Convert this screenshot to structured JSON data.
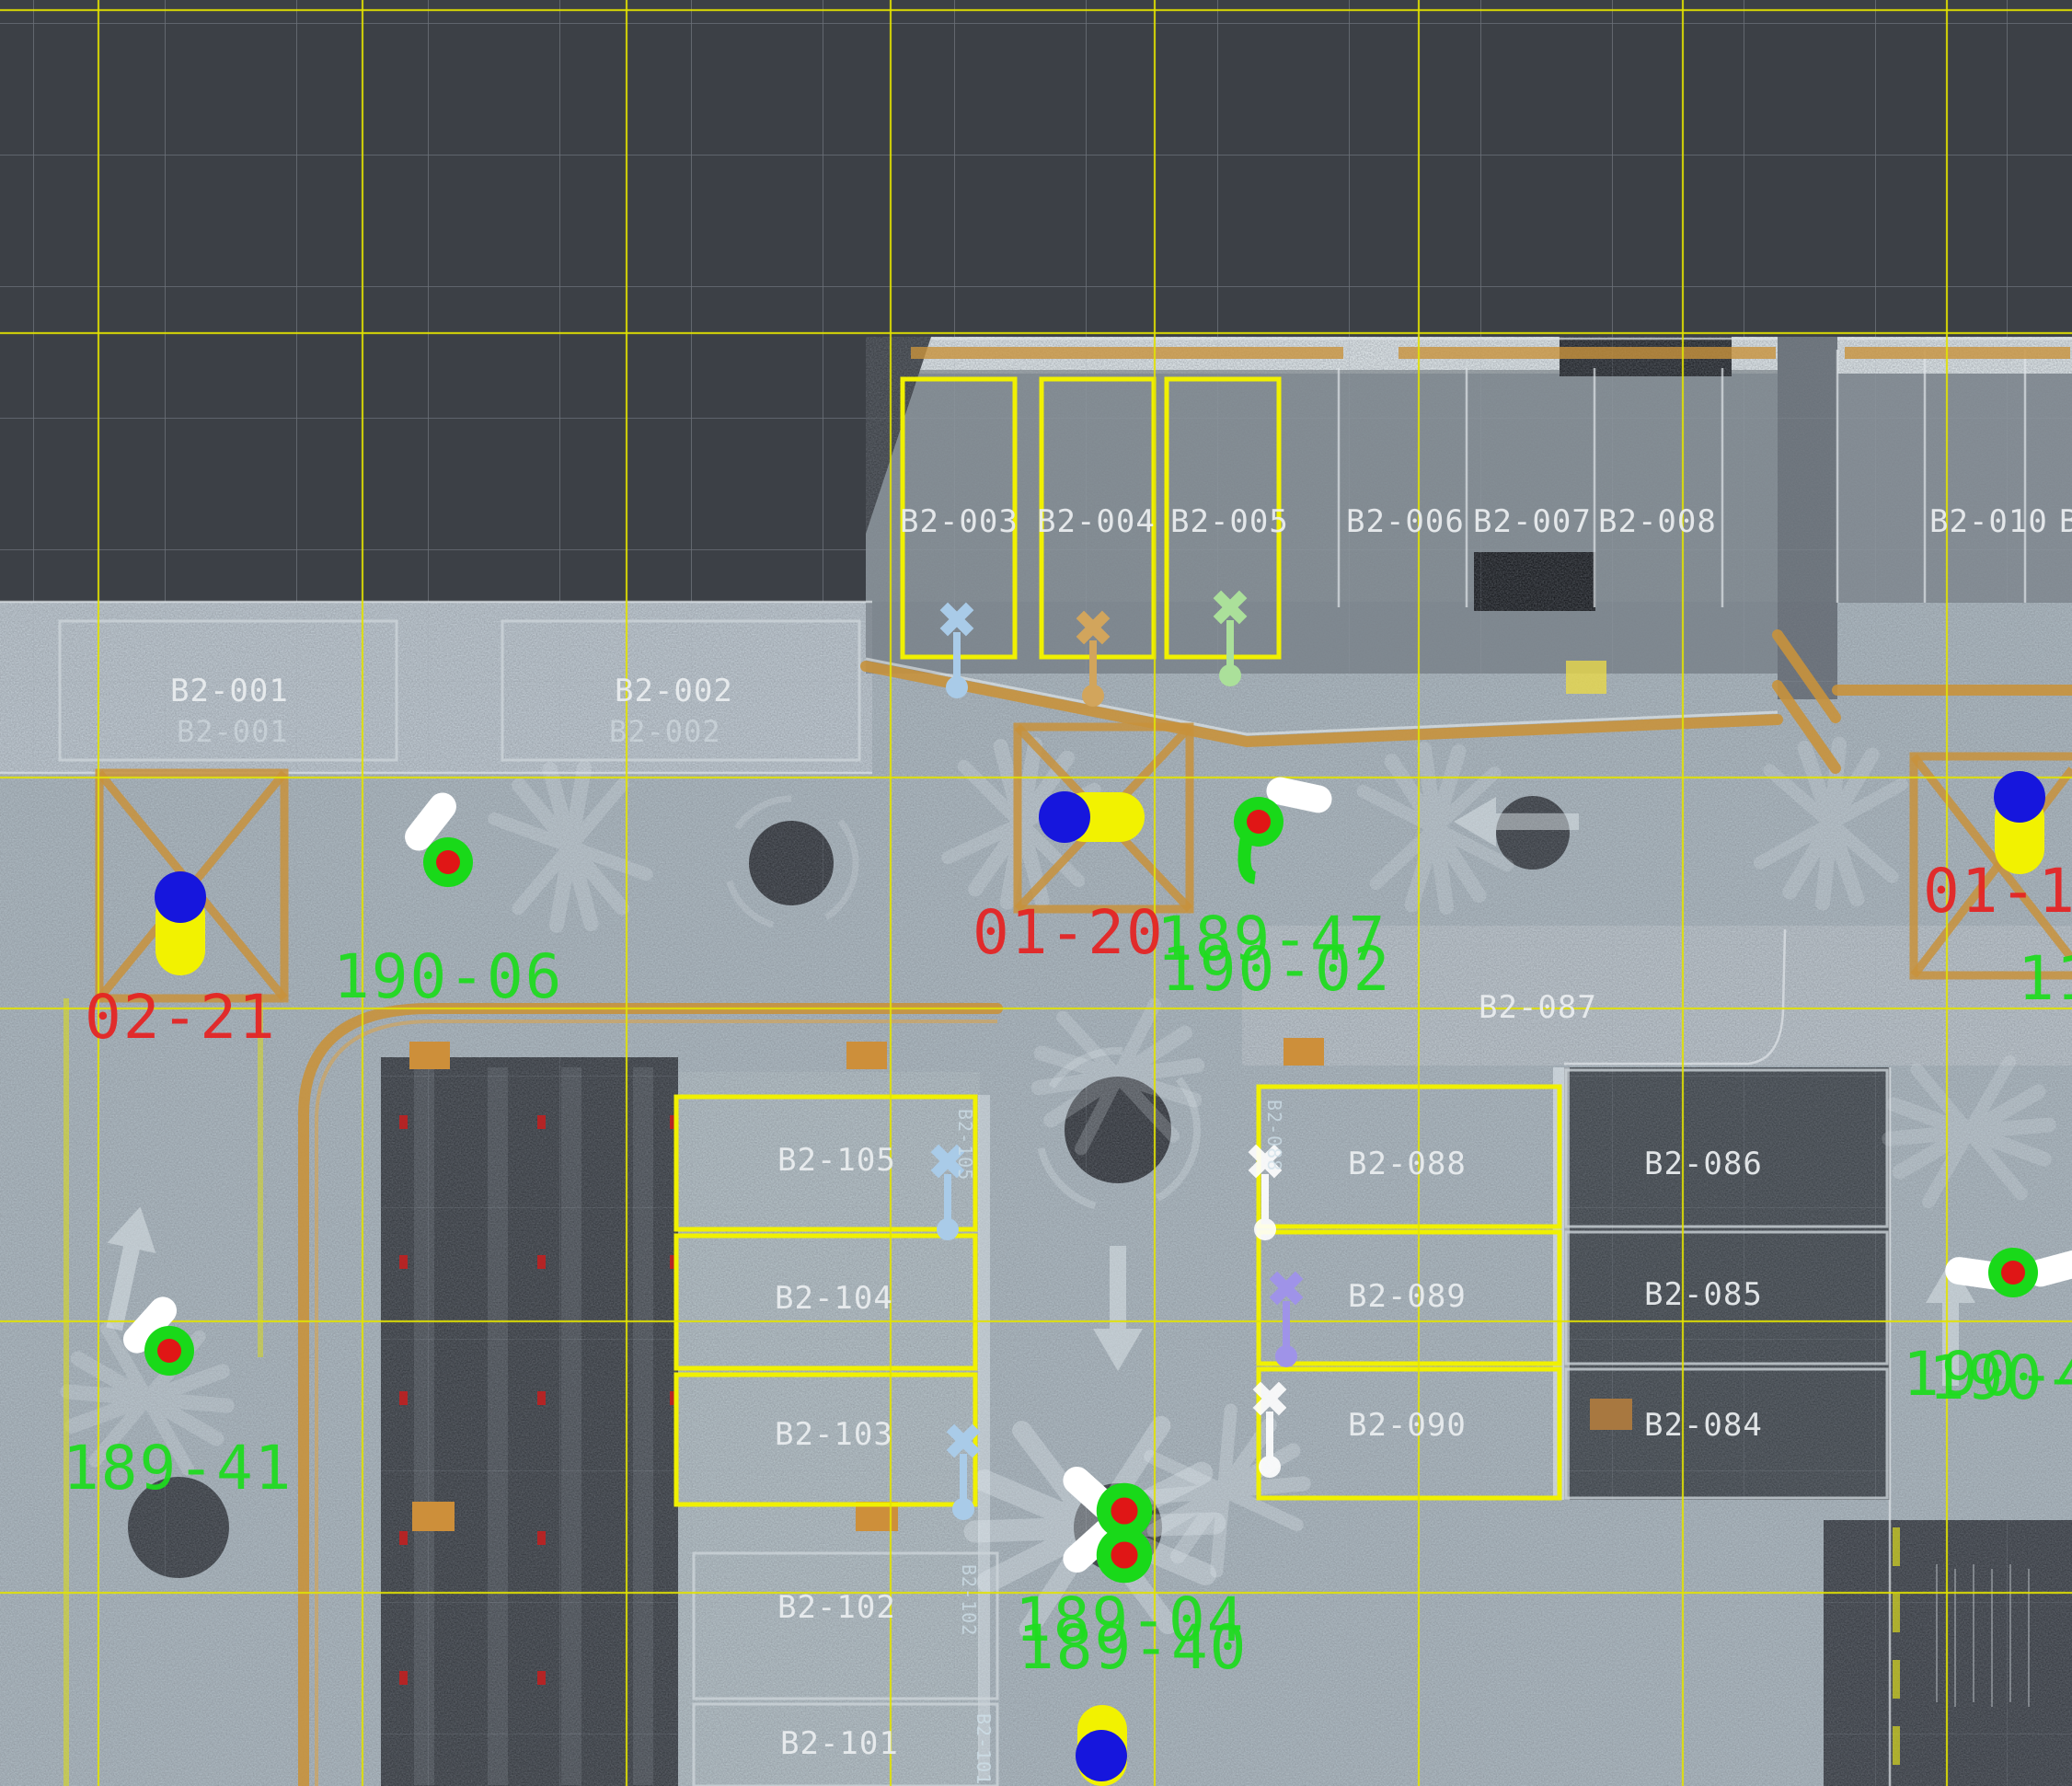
{
  "view": {
    "type": "point-cloud-plan",
    "level": "B2"
  },
  "colors": {
    "bg": "#3c4046",
    "pavement": "#adb9c1",
    "slab_light": "#c6cfd5",
    "dark_area": "#2c3036",
    "grid_gray": "#9aa2ab",
    "grid_yellow": "#e3e300",
    "stall_outline_yellow": "#f0f000",
    "outline_white": "#dfe4e8",
    "curb_orange": "#c8923c",
    "text_white": "#e9edef",
    "text_red": "#e62222",
    "text_green": "#1edc1e",
    "marker_blue": "#1616dd",
    "marker_yellow": "#f2f200",
    "marker_green": "#19d919",
    "marker_red": "#e01616",
    "pin_blue": "#a9cbe8",
    "pin_tan": "#d2a55c",
    "pin_green": "#abe09a",
    "pin_purple": "#9f93e8",
    "pill_white": "#ffffff"
  },
  "stalls": {
    "top": [
      "B2-003",
      "B2-004",
      "B2-005",
      "B2-006",
      "B2-007",
      "B2-008",
      "B2-010"
    ],
    "top_partial": "B",
    "left_block": [
      "B2-001",
      "B2-002"
    ],
    "left_block_painted": [
      "B2-001",
      "B2-002"
    ],
    "island": "B2-087",
    "right_inner": [
      "B2-088",
      "B2-089",
      "B2-090"
    ],
    "right_outer": [
      "B2-086",
      "B2-085",
      "B2-084"
    ],
    "center_column": [
      "B2-105",
      "B2-104",
      "B2-103",
      "B2-102",
      "B2-101"
    ],
    "vertical_small": [
      "B2-105",
      "B2-102",
      "B2-101",
      "B2-088"
    ]
  },
  "stations": {
    "red": [
      "01-20",
      "02-21",
      "01-1"
    ],
    "green": [
      "190-06",
      "189-47",
      "190-02",
      "189-41",
      "189-04",
      "189-40",
      "119",
      "190-4",
      "190-4"
    ]
  }
}
